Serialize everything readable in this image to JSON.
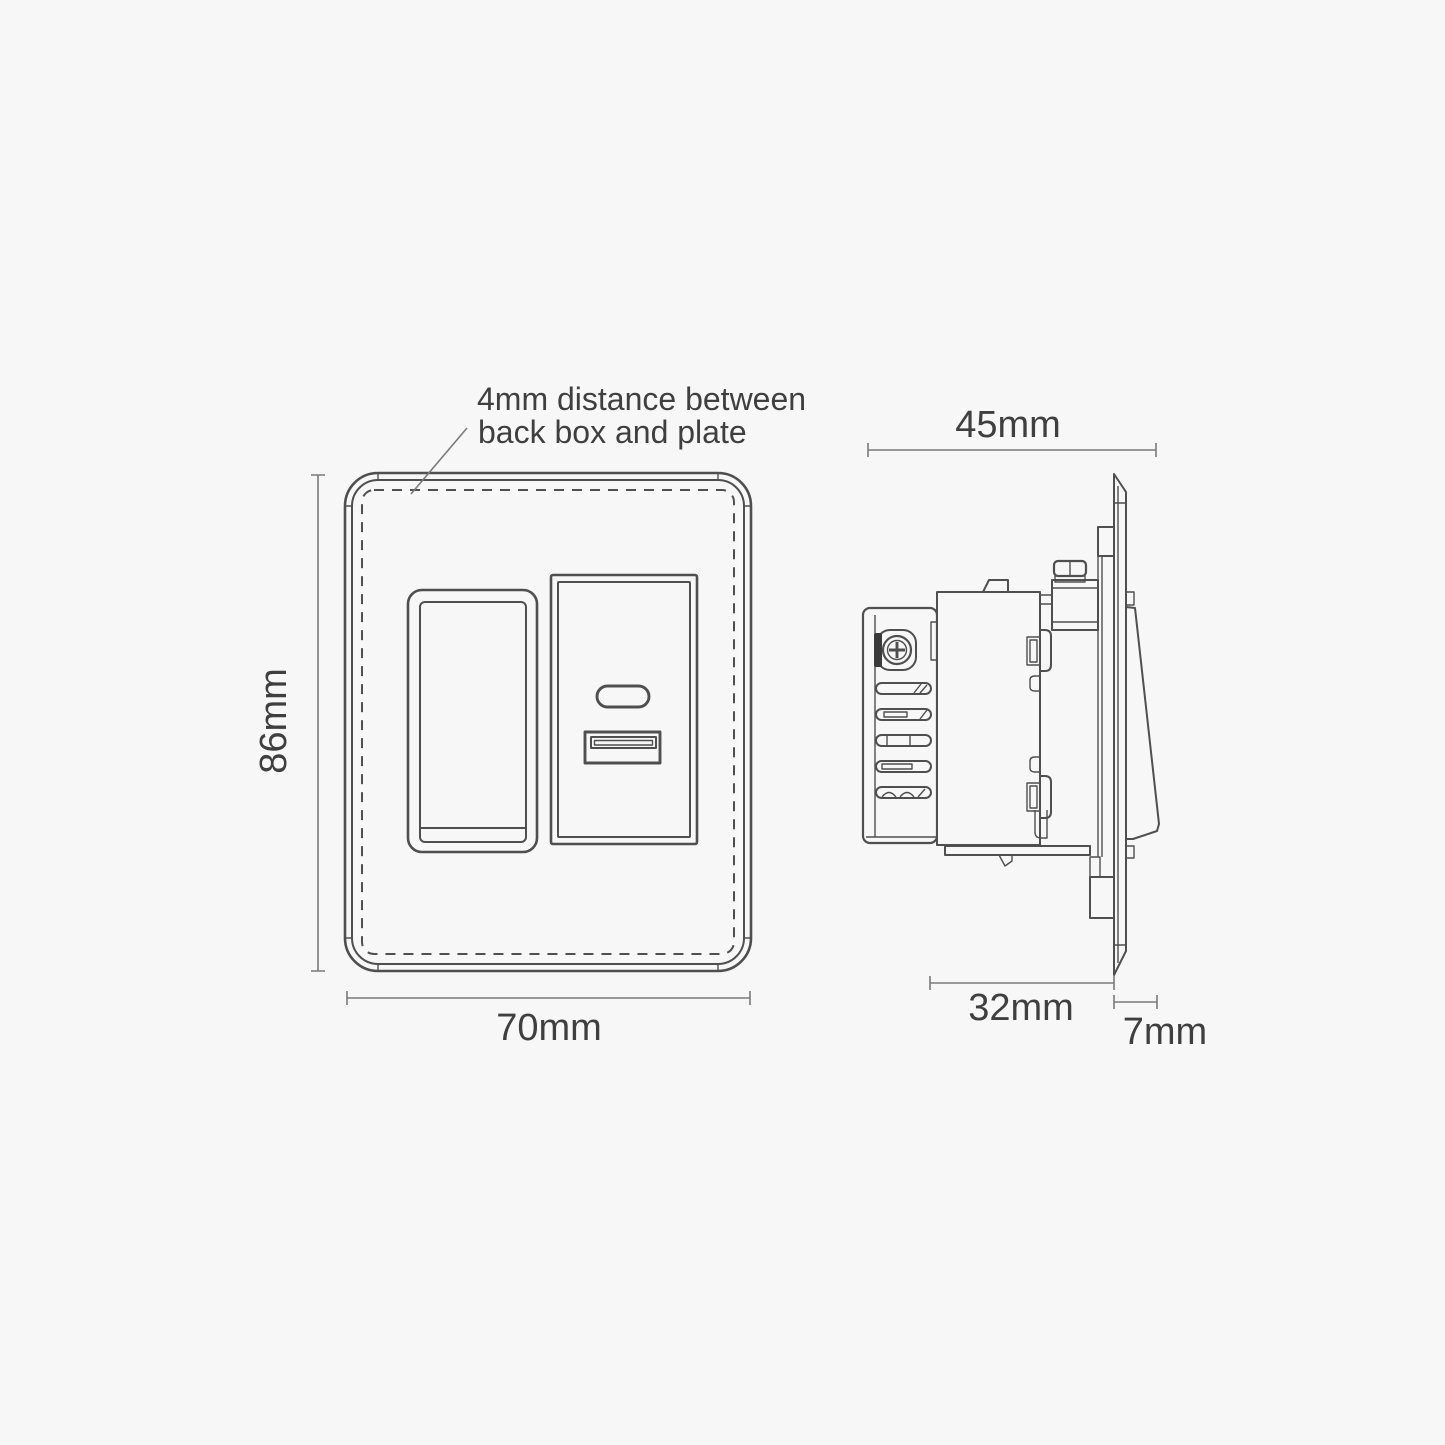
{
  "annotation": {
    "line1": "4mm distance between",
    "line2": "back box and plate"
  },
  "front_view": {
    "height_label": "86mm",
    "width_label": "70mm"
  },
  "side_view": {
    "overall_depth_label": "45mm",
    "backbox_depth_label": "32mm",
    "plate_depth_label": "7mm"
  },
  "colors": {
    "background": "#f7f7f7",
    "line": "#4f4f4f",
    "dimension_line": "#7a7a7a",
    "text": "#3f3f3f"
  }
}
